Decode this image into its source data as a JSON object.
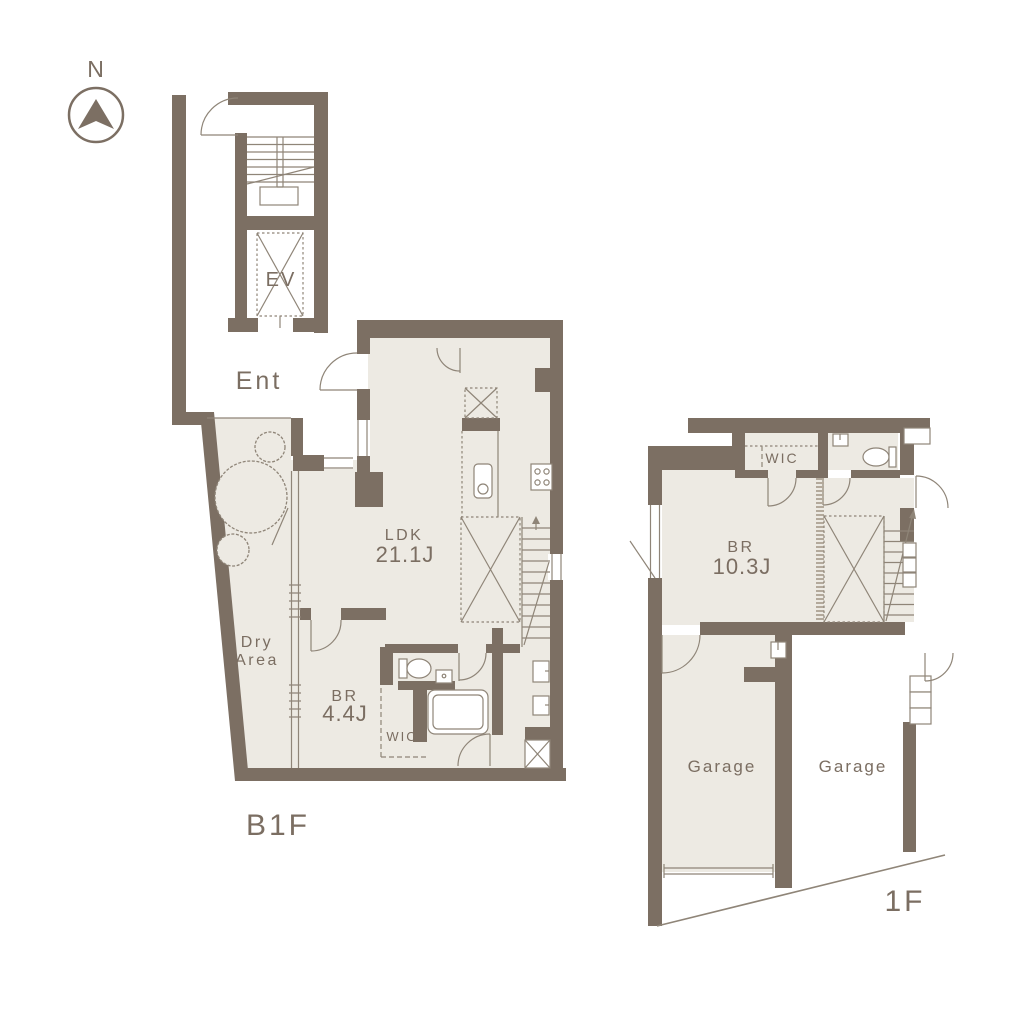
{
  "colors": {
    "wall": "#7c6f63",
    "floor": "#edeae3",
    "line": "#8f8578",
    "text": "#7b6e62",
    "background": "#ffffff"
  },
  "compass": {
    "label": "N"
  },
  "b1f": {
    "floor_label": "B1F",
    "rooms": {
      "entrance": "Ent",
      "elevator": "EV",
      "ldk": {
        "name": "LDK",
        "size": "21.1J"
      },
      "dry_area": {
        "line1": "Dry",
        "line2": "Area"
      },
      "bedroom": {
        "name": "BR",
        "size": "4.4J"
      },
      "wic": "WIC"
    }
  },
  "f1": {
    "floor_label": "1F",
    "rooms": {
      "wic": "WIC",
      "bedroom": {
        "name": "BR",
        "size": "10.3J"
      },
      "garage_left": "Garage",
      "garage_right": "Garage"
    }
  }
}
